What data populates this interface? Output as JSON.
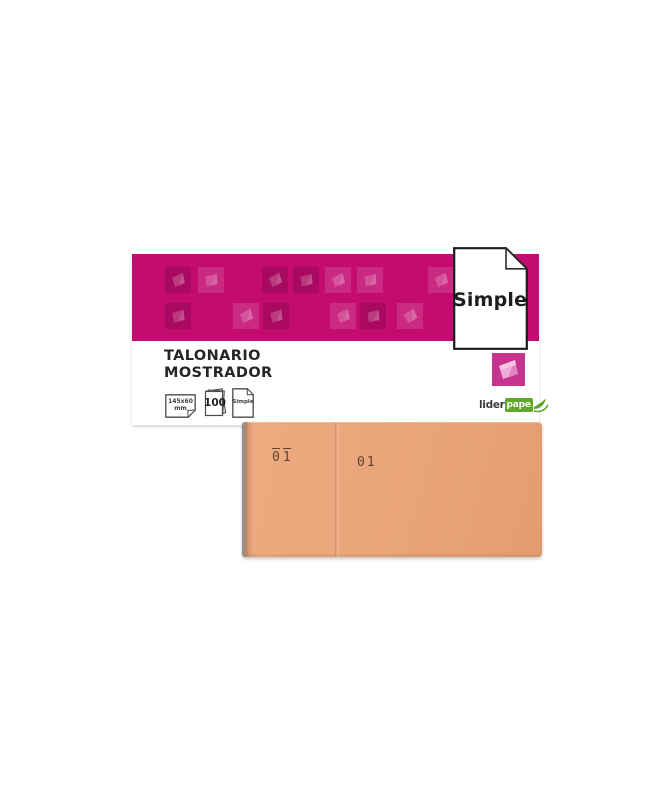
{
  "page": {
    "background": "#ffffff"
  },
  "label": {
    "band_color": "#c30b70",
    "title_line1": "TALONARIO",
    "title_line2": "MOSTRADOR",
    "icons": {
      "size": {
        "line1": "145x60",
        "line2": "mm"
      },
      "sheets": {
        "count": "100"
      },
      "type": {
        "label": "Simple"
      }
    },
    "brand": {
      "prefix": "lider",
      "box_text": "pape",
      "green": "#5fa829"
    },
    "category_icon_color": "#c5358f"
  },
  "flag_card": {
    "label": "Simple"
  },
  "book": {
    "color": "#e9a478",
    "stub_number": "01",
    "main_number": "01"
  },
  "decor": {
    "squares": [
      {
        "row": 1,
        "x": 33,
        "variant": "dark",
        "tilt": -4
      },
      {
        "row": 1,
        "x": 66,
        "variant": "light",
        "tilt": 6
      },
      {
        "row": 1,
        "x": 130,
        "variant": "dark",
        "tilt": -8
      },
      {
        "row": 1,
        "x": 161,
        "variant": "dark",
        "tilt": 4
      },
      {
        "row": 1,
        "x": 193,
        "variant": "light",
        "tilt": -5
      },
      {
        "row": 1,
        "x": 225,
        "variant": "light",
        "tilt": 8
      },
      {
        "row": 1,
        "x": 296,
        "variant": "light",
        "tilt": -6
      },
      {
        "row": 2,
        "x": 33,
        "variant": "dark",
        "tilt": 5
      },
      {
        "row": 2,
        "x": 101,
        "variant": "light",
        "tilt": -7
      },
      {
        "row": 2,
        "x": 131,
        "variant": "dark",
        "tilt": 3
      },
      {
        "row": 2,
        "x": 198,
        "variant": "light",
        "tilt": -4
      },
      {
        "row": 2,
        "x": 228,
        "variant": "dark",
        "tilt": 7
      },
      {
        "row": 2,
        "x": 265,
        "variant": "light",
        "tilt": -14
      }
    ]
  }
}
